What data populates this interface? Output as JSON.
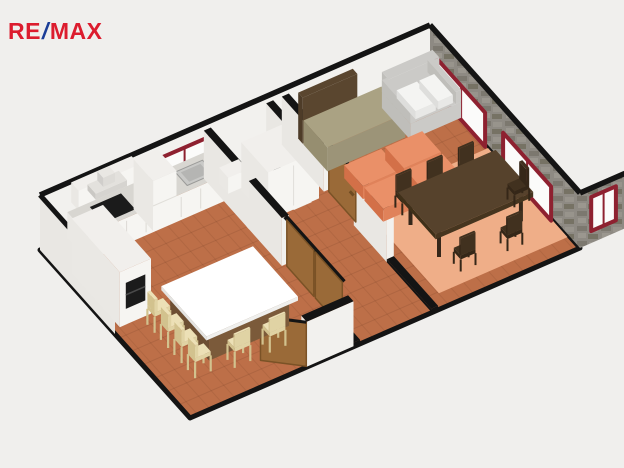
{
  "logo": {
    "re": "RE",
    "slash": "/",
    "max": "MAX",
    "red": "#dc1c2e",
    "blue": "#1b3d97"
  },
  "scene": {
    "background": "#f0efed",
    "colors": {
      "floor": "#bd6f48",
      "outline": "#141414",
      "wall": "#f2f1ee",
      "wall_outer": "#e9e7e3",
      "stone": "#8e8a83",
      "window_frame": "#8e2130",
      "window_glass": "#fbfbfa",
      "door": "#9a6a38",
      "door_edge": "#7a5226",
      "cabinet": "#f6f5f2",
      "cabinet_side": "#eae8e4",
      "cabinet_top": "#f1efec",
      "counter": "#d8d6d1",
      "appliance": "#1b1b1b",
      "sink": "#c9c9c7",
      "sink_basin": "#b5b5b3",
      "island_base": "#7b5a3a",
      "island_base_side": "#6d4f33",
      "island_top": "#ffffff",
      "stool": "#ece0b6",
      "stool_mid": "#e0d3a4",
      "stool_dark": "#d2c28e",
      "sofa": "#cbcac7",
      "sofa_side": "#bfbeba",
      "cushion": "#f4f4f2",
      "module": "#e0825a",
      "module_top": "#ea9068",
      "module_side": "#d37048",
      "rug": "#efae88",
      "table": "#56422c",
      "table_side": "#46351f",
      "chair": "#41311f",
      "chair_dark": "#352718",
      "bench": "#aaa283",
      "bench_side": "#968e70",
      "headboard": "#5a462f"
    }
  }
}
